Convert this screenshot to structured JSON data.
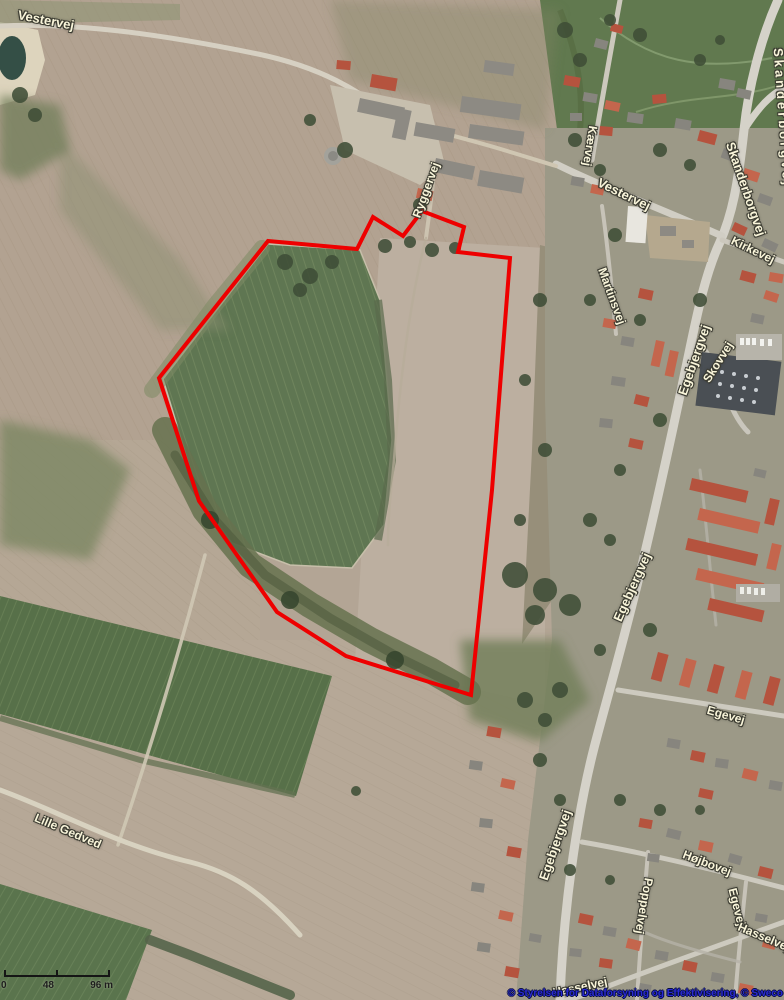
{
  "map": {
    "street_labels": [
      {
        "id": "vestervej-nw",
        "text": "Vestervej",
        "x": 46,
        "y": 20,
        "rotation": 11,
        "size": 13
      },
      {
        "id": "skanderborgvej-ne",
        "text": "Skanderborgvej",
        "x": 783,
        "y": 118,
        "rotation": 86,
        "size": 13,
        "spacing": 3
      },
      {
        "id": "kaervej",
        "text": "Kærvej",
        "x": 590,
        "y": 146,
        "rotation": 99,
        "size": 12
      },
      {
        "id": "vestervej",
        "text": "Vestervej",
        "x": 624,
        "y": 194,
        "rotation": 26,
        "size": 13
      },
      {
        "id": "skanderborgvej",
        "text": "Skanderborgvej",
        "x": 746,
        "y": 189,
        "rotation": 71,
        "size": 13
      },
      {
        "id": "kirkevej",
        "text": "Kirkevej",
        "x": 753,
        "y": 250,
        "rotation": 26,
        "size": 12
      },
      {
        "id": "martinsvej",
        "text": "Martinsvej",
        "x": 612,
        "y": 296,
        "rotation": 70,
        "size": 12
      },
      {
        "id": "ryggervej",
        "text": "Ryggervej",
        "x": 426,
        "y": 190,
        "rotation": -70,
        "size": 12
      },
      {
        "id": "egebjergvej-nord",
        "text": "Egebjergvej",
        "x": 694,
        "y": 360,
        "rotation": -71,
        "size": 13
      },
      {
        "id": "skovvej",
        "text": "Skovvej",
        "x": 718,
        "y": 362,
        "rotation": -58,
        "size": 12
      },
      {
        "id": "egebjergvej-midt",
        "text": "Egebjergvej",
        "x": 632,
        "y": 587,
        "rotation": -66,
        "size": 13
      },
      {
        "id": "egevej-nord",
        "text": "Egevej",
        "x": 726,
        "y": 715,
        "rotation": 16,
        "size": 12
      },
      {
        "id": "egebjergvej-syd",
        "text": "Egebjergvej",
        "x": 555,
        "y": 845,
        "rotation": -71,
        "size": 13
      },
      {
        "id": "lille-gedved",
        "text": "Lille Gedved",
        "x": 68,
        "y": 831,
        "rotation": 23,
        "size": 12
      },
      {
        "id": "hojbovej",
        "text": "Højbovej",
        "x": 707,
        "y": 863,
        "rotation": 21,
        "size": 12
      },
      {
        "id": "poppelvej",
        "text": "Poppelvej",
        "x": 644,
        "y": 906,
        "rotation": 100,
        "size": 12
      },
      {
        "id": "egevej-syd",
        "text": "Egevej",
        "x": 737,
        "y": 907,
        "rotation": 76,
        "size": 12
      },
      {
        "id": "hasselvej",
        "text": "Hasselvej",
        "x": 764,
        "y": 937,
        "rotation": 23,
        "size": 12
      },
      {
        "id": "hasselvej-syd",
        "text": "Hasselvej",
        "x": 580,
        "y": 987,
        "rotation": -12,
        "size": 12
      }
    ],
    "label_color": "#f9f5da",
    "parcel_outline": {
      "color": "#ee0000",
      "stroke_width": 4,
      "points": [
        [
          268,
          241
        ],
        [
          357,
          249
        ],
        [
          373,
          217
        ],
        [
          403,
          236
        ],
        [
          422,
          211
        ],
        [
          464,
          227
        ],
        [
          458,
          252
        ],
        [
          510,
          258
        ],
        [
          492,
          490
        ],
        [
          471,
          695
        ],
        [
          346,
          656
        ],
        [
          277,
          612
        ],
        [
          227,
          541
        ],
        [
          199,
          501
        ],
        [
          159,
          378
        ]
      ]
    },
    "scale_bar": {
      "start_label": "0",
      "mid_label": "48",
      "end_label": "96",
      "unit": "m"
    },
    "attribution": "© Styrelsen for Dataforsyning og Effektivisering, © Sweco",
    "attribution_color": "#2a2ad4"
  }
}
